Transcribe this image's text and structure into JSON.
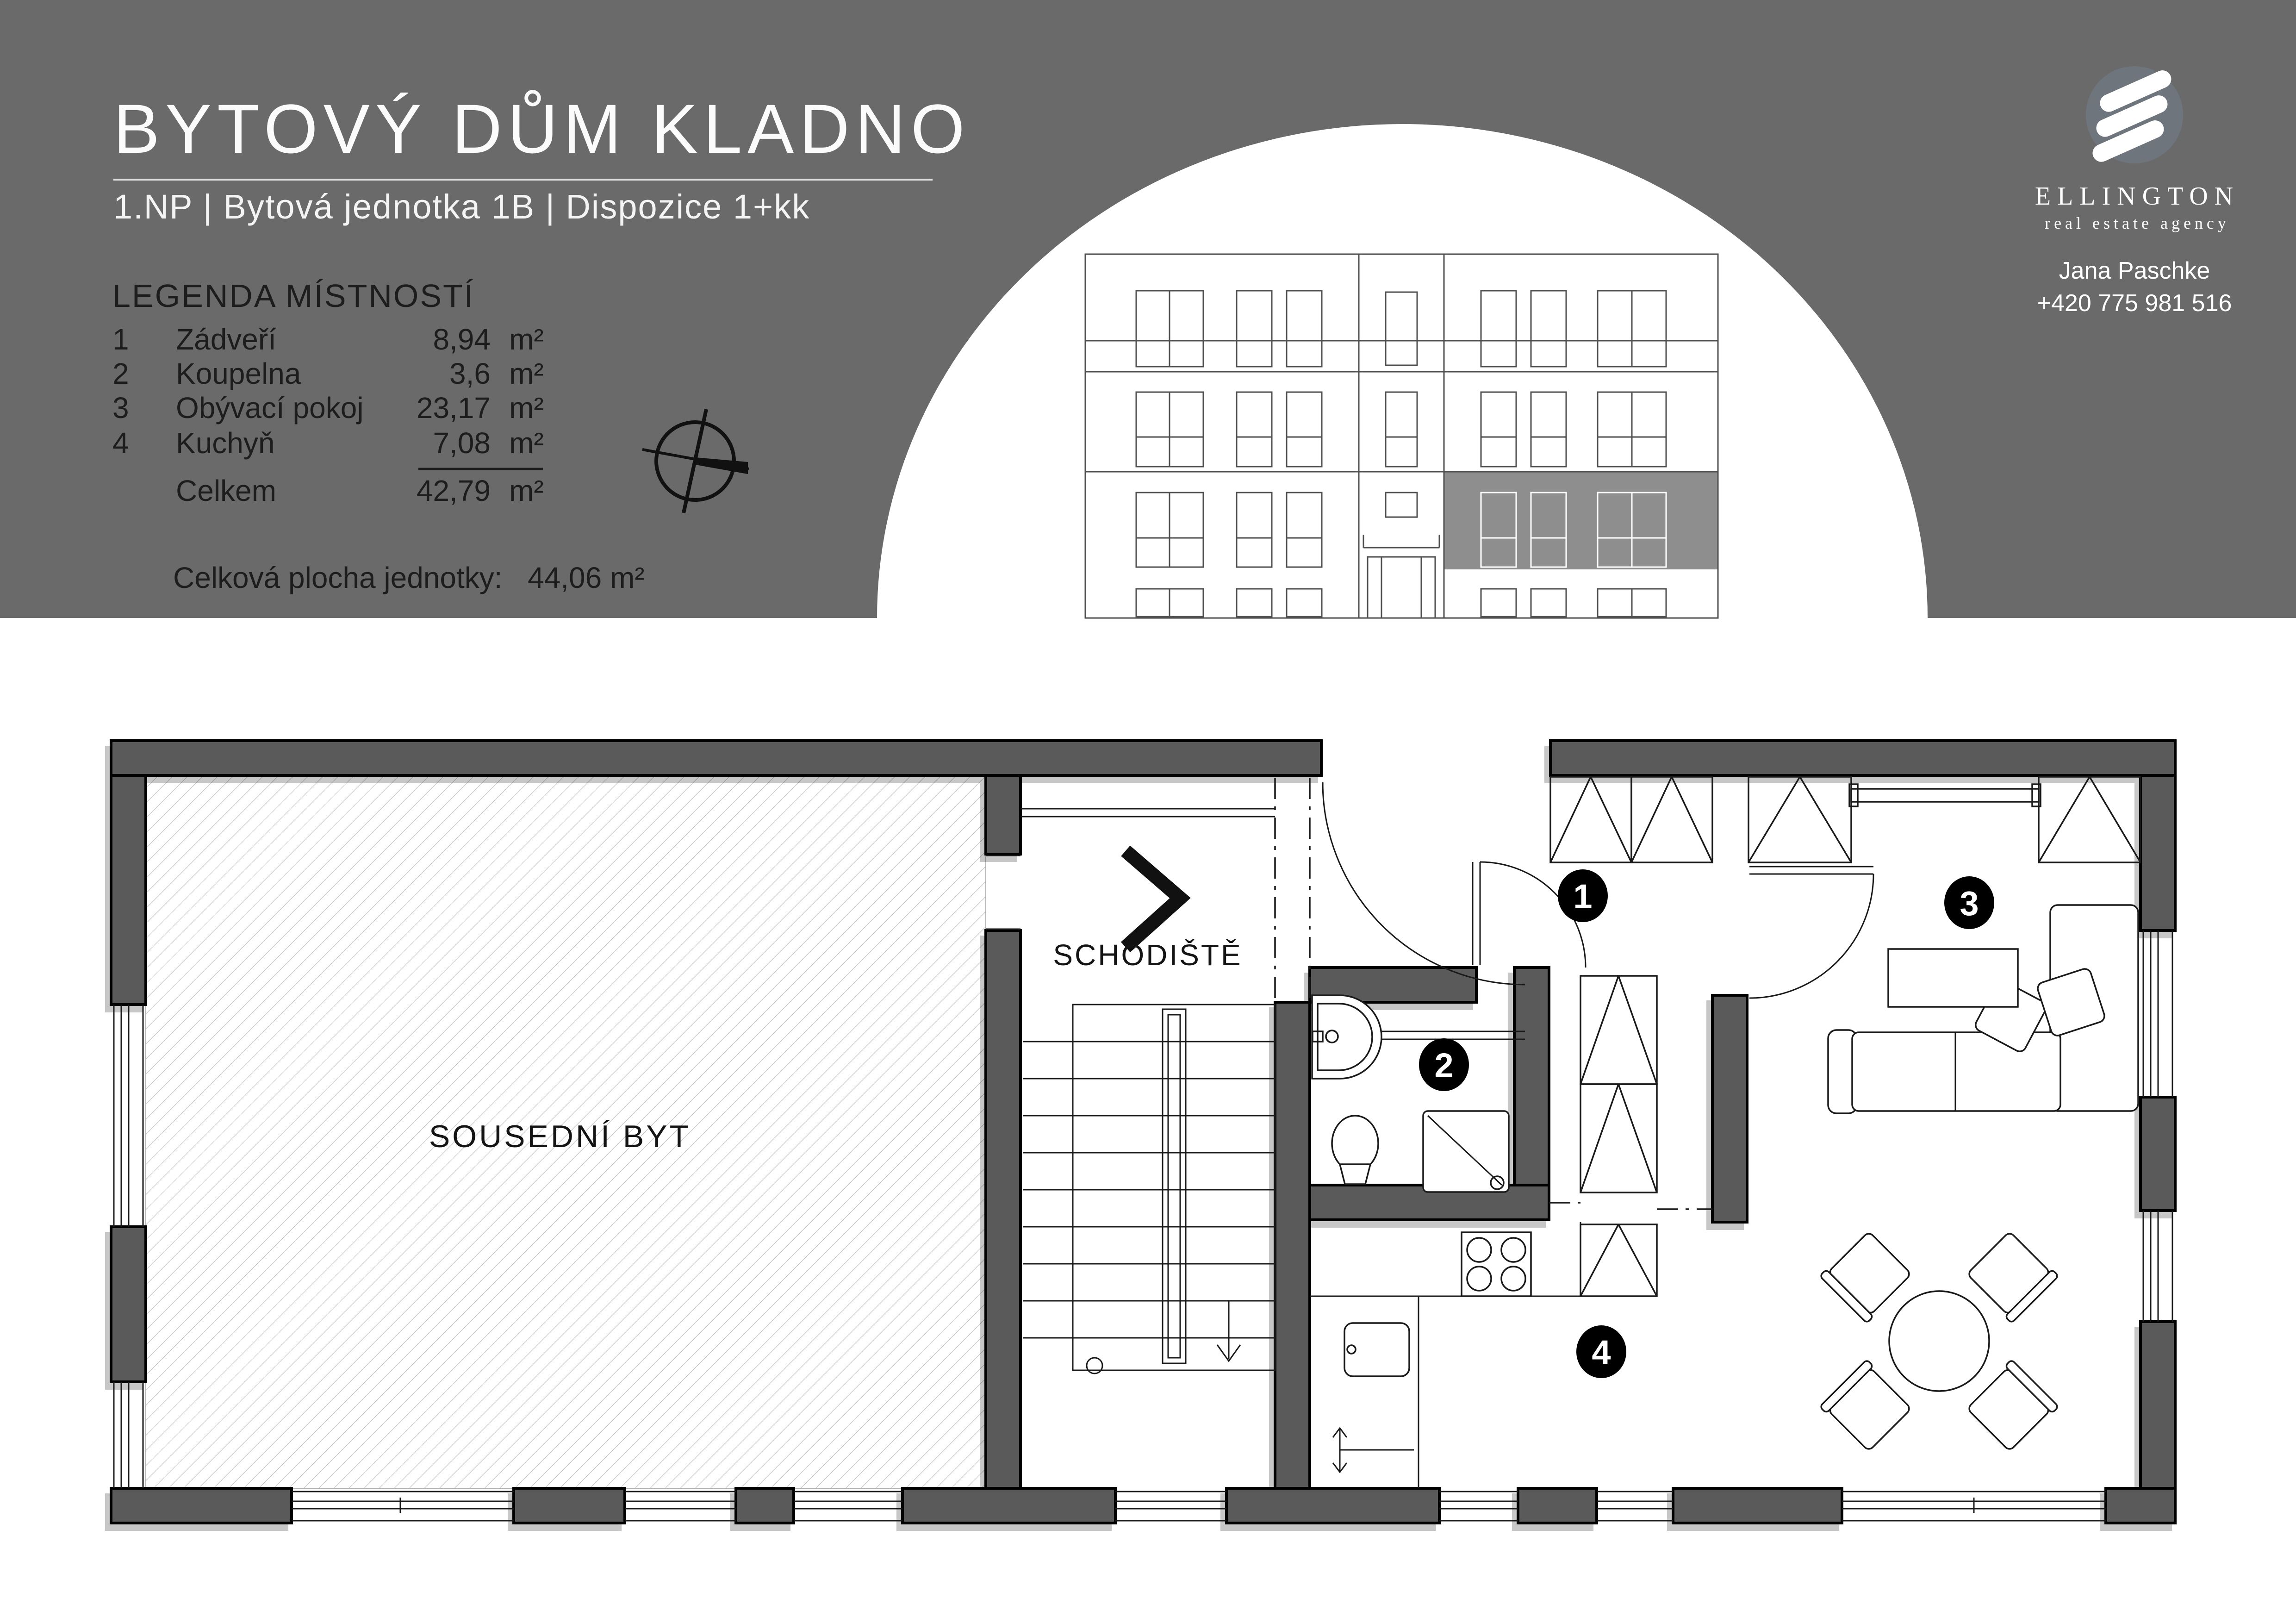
{
  "header": {
    "title": "BYTOVÝ DŮM KLADNO",
    "subtitle": "1.NP | Bytová jednotka 1B | Dispozice 1+kk",
    "legend_heading": "LEGENDA MÍSTNOSTÍ",
    "rooms": [
      {
        "num": "1",
        "name": "Zádveří",
        "area": "8,94",
        "unit": "m²"
      },
      {
        "num": "2",
        "name": "Koupelna",
        "area": "3,6",
        "unit": "m²"
      },
      {
        "num": "3",
        "name": "Obývací pokoj",
        "area": "23,17",
        "unit": "m²"
      },
      {
        "num": "4",
        "name": "Kuchyň",
        "area": "7,08",
        "unit": "m²"
      }
    ],
    "total_label": "Celkem",
    "total_area": "42,79",
    "total_unit": "m²",
    "unit_total_label": "Celková plocha jednotky:",
    "unit_total_value": "44,06 m²"
  },
  "agency": {
    "name": "ELLINGTON",
    "tagline": "real estate agency",
    "agent": "Jana Paschke",
    "phone": "+420 775 981 516"
  },
  "plan": {
    "neighbor_label": "SOUSEDNÍ BYT",
    "stairs_label": "SCHODIŠTĚ",
    "badges": [
      "1",
      "2",
      "3",
      "4"
    ]
  },
  "colors": {
    "header_bg": "#6a6a6a",
    "wall": "#5a5a5a",
    "elevation_line": "#4f4f4f",
    "unit_highlight": "#8e8e8e",
    "logo_circle": "#6e757d",
    "badge": "#000000"
  }
}
